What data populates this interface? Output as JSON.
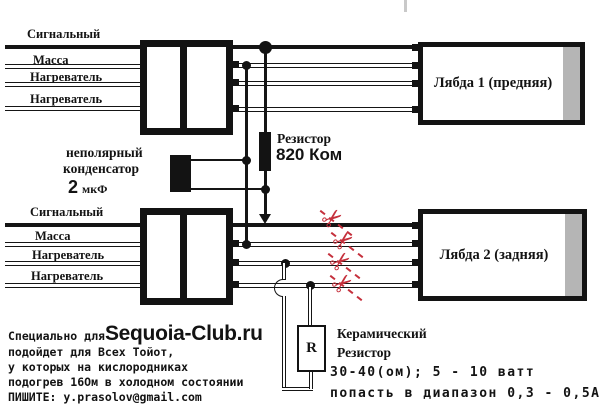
{
  "diagram": {
    "scissors_glyph": "✂",
    "top": {
      "wires": [
        "Сигнальный",
        "Масса",
        "Нагреватель",
        "Нагреватель"
      ],
      "lambda_label": "Лябда 1 (предняя)"
    },
    "bottom": {
      "wires": [
        "Сигнальный",
        "Масса",
        "Нагреватель",
        "Нагреватель"
      ],
      "lambda_label": "Лябда 2 (задняя)"
    },
    "resistor": {
      "label": "Резистор",
      "value": "820 Ком"
    },
    "capacitor": {
      "line1": "неполярный",
      "line2": "конденсатор",
      "value": "2",
      "unit": "мкФ"
    },
    "ceramic": {
      "symbol": "R",
      "line1": "Керамический",
      "line2": "Резистор",
      "line3": "30-40(ом); 5 - 10 ватт",
      "line4": "попасть в диапазон 0,3 - 0,5А"
    }
  },
  "footer": {
    "prefix": "Специально для ",
    "brand": "Sequoia-Club.ru",
    "line2": "подойдет для Всех Тойот,",
    "line3": "у которых на кислородниках",
    "line4": "подогрев 16Ом в холодном состоянии",
    "line5": "ПИШИТЕ: y.prasolov@gmail.com"
  },
  "colors": {
    "cut": "#c5303c",
    "strip": "#b5b5b5",
    "ink": "#131313"
  }
}
